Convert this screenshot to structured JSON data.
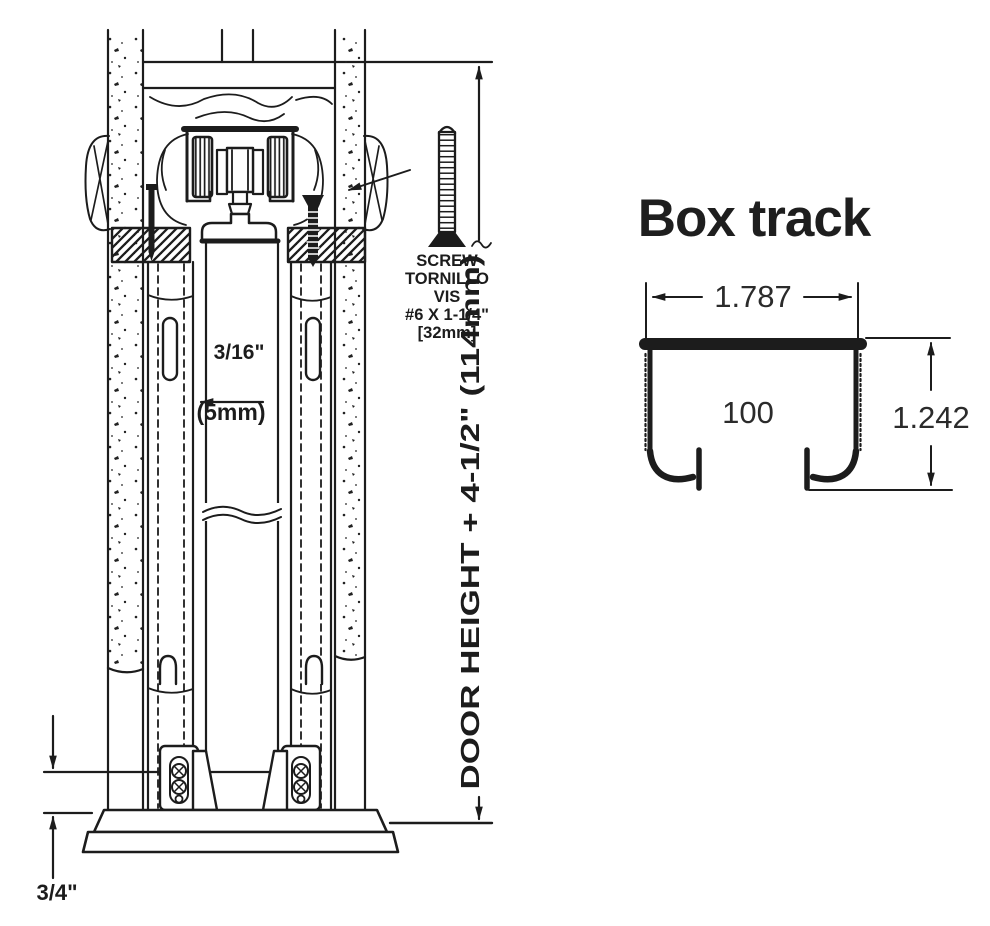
{
  "colors": {
    "ink": "#1c1c1c",
    "background": "#ffffff"
  },
  "assembly_diagram": {
    "screw_callout": {
      "lines": [
        "SCREW",
        "TORNILLO",
        "VIS",
        "#6 X 1-1/4\"",
        "[32mm]"
      ]
    },
    "door_gap_dimension": {
      "inches": "3/16\"",
      "metric": "(5mm)"
    },
    "door_height_dimension": "DOOR HEIGHT + 4-1/2\" (114mm)",
    "floor_clearance_dimension": "3/4\""
  },
  "box_track_detail": {
    "title": "Box track",
    "width_dimension": "1.787",
    "profile_number": "100",
    "height_dimension": "1.242"
  }
}
